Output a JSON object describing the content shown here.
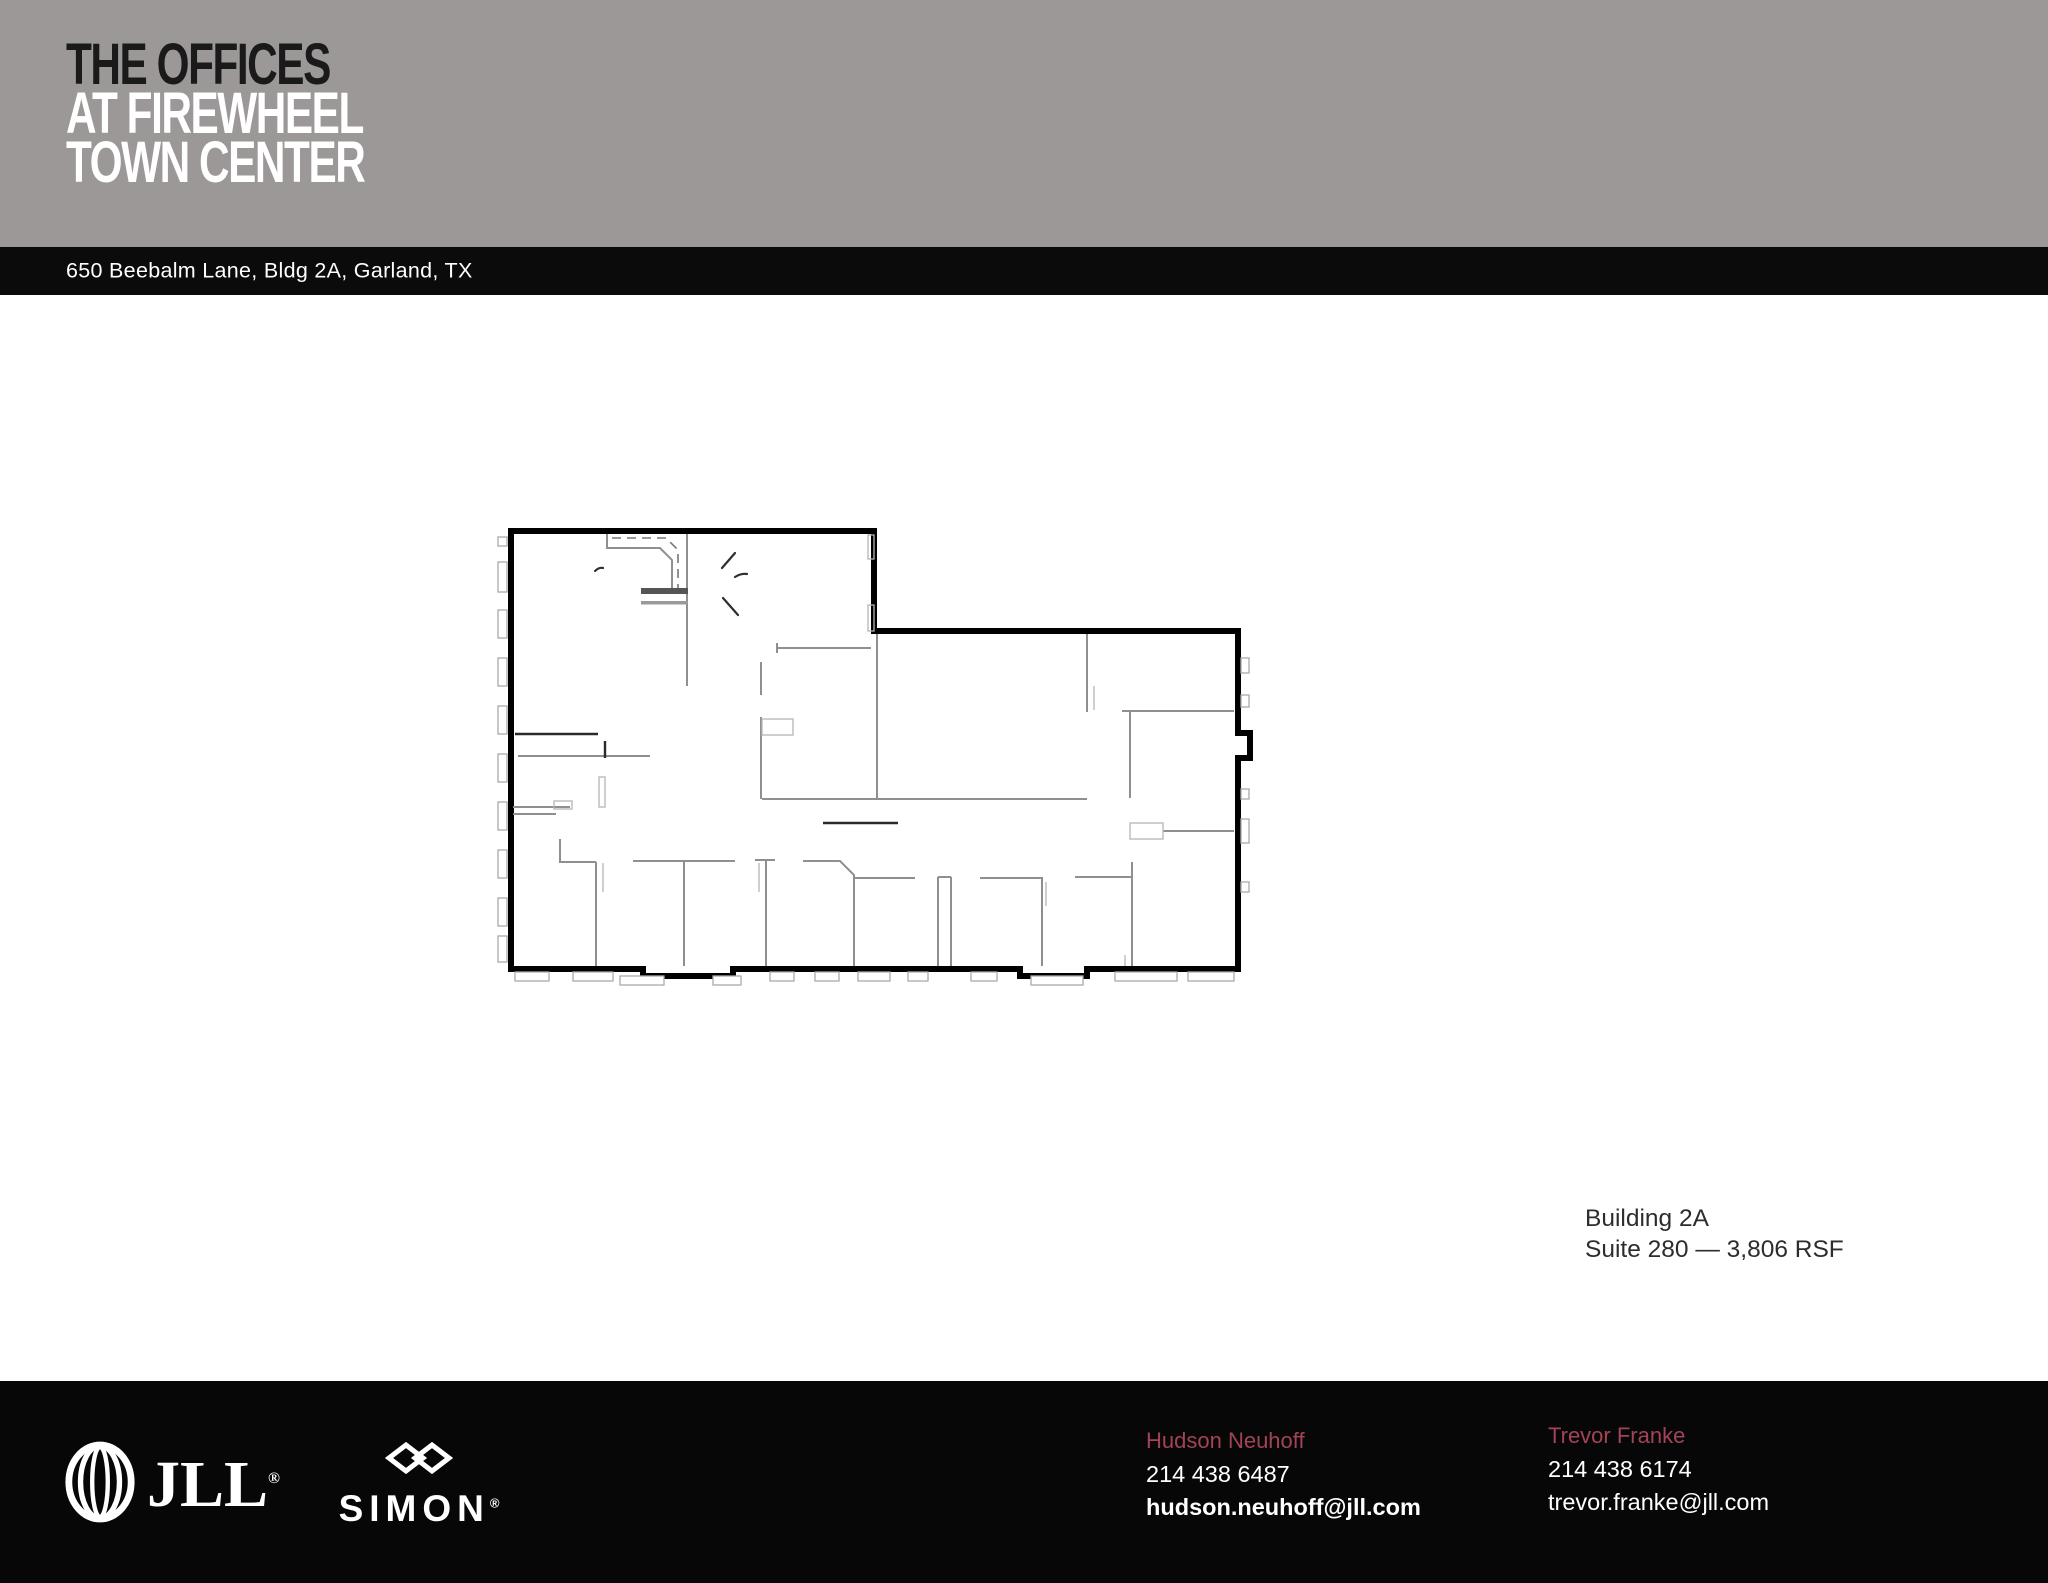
{
  "header": {
    "title_line1": "THE OFFICES",
    "title_line2": "AT FIREWHEEL",
    "title_line3": "TOWN CENTER",
    "background": "#9B9897",
    "line1_color": "#1A1A1A",
    "line23_color": "#FFFFFF"
  },
  "address_bar": {
    "text": "650 Beebalm Lane, Bldg 2A, Garland, TX",
    "background": "#0B0B0B",
    "text_color": "#FFFFFF"
  },
  "plan_label": {
    "line1": "Building 2A",
    "line2": "Suite 280 — 3,806 RSF"
  },
  "footer": {
    "background": "#070707",
    "accent_color": "#A34357",
    "jll_text": "JLL",
    "simon_text": "SIMON",
    "reg_mark": "®",
    "contacts": [
      {
        "name": "Hudson Neuhoff",
        "phone": "214 438 6487",
        "email": "hudson.neuhoff@jll.com"
      },
      {
        "name": "Trevor Franke",
        "phone": "214 438 6174",
        "email": "trevor.franke@jll.com"
      }
    ]
  }
}
